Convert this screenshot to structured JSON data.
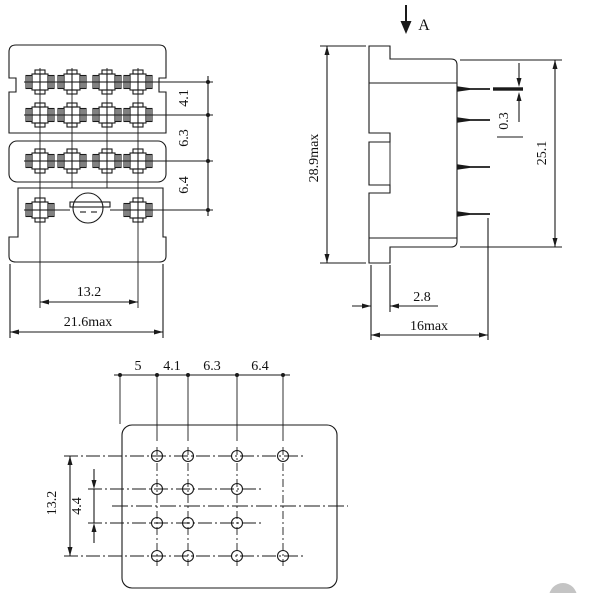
{
  "title": "Relay socket dimensional drawing (three views)",
  "front_view": {
    "row_spacing_dims": [
      "4.1",
      "6.3",
      "6.4"
    ],
    "terminal_span_dim": "13.2",
    "overall_width_dim": "21.6max"
  },
  "side_view": {
    "section_arrow_label": "A",
    "overall_height_dim": "28.9max",
    "pin_thickness_dim": "0.3",
    "body_height_dim": "25.1",
    "foot_offset_dim": "2.8",
    "overall_depth_dim": "16max"
  },
  "bottom_view": {
    "pitch_chain_dims": [
      "5",
      "4.1",
      "6.3",
      "6.4"
    ],
    "row_span_dim": "13.2",
    "row_pitch_dim": "4.4"
  },
  "colors": {
    "line": "#1a1a1a",
    "background": "#ffffff",
    "watermark": "#b5b5b5"
  }
}
